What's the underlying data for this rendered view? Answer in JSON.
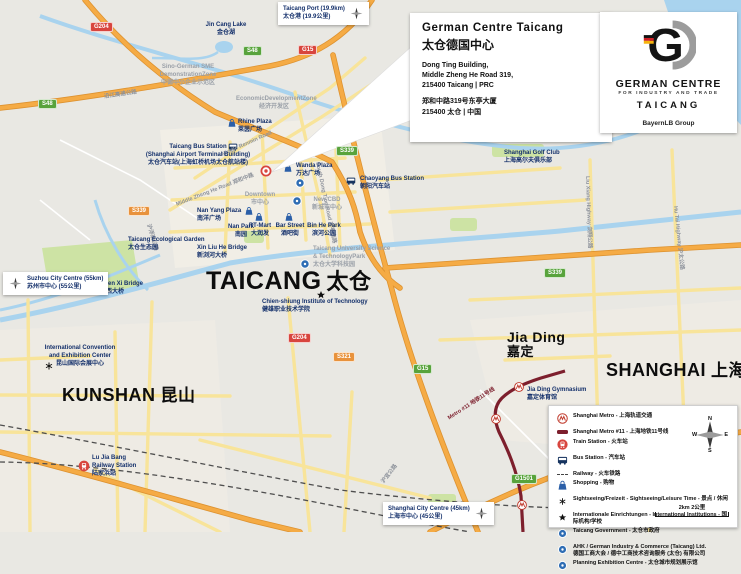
{
  "callout": {
    "title_en": "German Centre Taicang",
    "title_zh": "太仓德国中心",
    "address_lines": [
      "Dong Ting Building,",
      "Middle Zheng He Road 319,",
      "215400 Taicang | PRC"
    ],
    "address_zh_lines": [
      "郑和中路319号东亭大厦",
      "215400 太仓 | 中国"
    ]
  },
  "logo_card": {
    "logo_letter": "G",
    "brand_line1": "GERMAN CENTRE",
    "brand_line2": "FOR INDUSTRY AND TRADE",
    "brand_city": "TAICANG",
    "brand_group": "BayernLB Group"
  },
  "distance_boxes": [
    {
      "en": "Taicang Port (19.9km)",
      "zh": "太仓港 (19.9公里)"
    },
    {
      "en": "Suzhou City Centre (55km)",
      "zh": "苏州市中心 (55公里)"
    },
    {
      "en": "Shanghai City Centre (45km)",
      "zh": "上海市中心 (45公里)"
    }
  ],
  "cities": [
    {
      "en": "TAICANG",
      "zh": "太仓"
    },
    {
      "en": "KUNSHAN",
      "zh": "昆山"
    },
    {
      "en": "SHANGHAI",
      "zh": "上海"
    },
    {
      "en": "Jia Ding",
      "zh": "嘉定"
    }
  ],
  "pois": [
    {
      "lines": [
        "Taicang Bus Station",
        "(Shanghai Airport Terminal Building)",
        "太仓汽车站(上海虹桥机场太仓航站楼)"
      ]
    },
    {
      "lines": [
        "Wanda Plaza",
        "万达广场"
      ]
    },
    {
      "lines": [
        "Chaoyang Bus Station",
        "朝阳汽车站"
      ]
    },
    {
      "lines": [
        "New CBD",
        "新城市中心"
      ]
    },
    {
      "lines": [
        "Downtown",
        "市中心"
      ]
    },
    {
      "lines": [
        "Nan Yang Plaza",
        "南洋广场"
      ]
    },
    {
      "lines": [
        "Nan Park",
        "南园"
      ]
    },
    {
      "lines": [
        "RT-Mart",
        "大润发"
      ]
    },
    {
      "lines": [
        "Bar Street",
        "酒吧街"
      ]
    },
    {
      "lines": [
        "Bin He Park",
        "滨河公园"
      ]
    },
    {
      "lines": [
        "Taicang Ecological Garden",
        "太仓生态园"
      ]
    },
    {
      "lines": [
        "Xin Liu He Bridge",
        "新浏河大桥"
      ]
    },
    {
      "lines": [
        "Taicang University Science",
        "& TechnologyPark",
        "太仓大学科技园"
      ]
    },
    {
      "lines": [
        "Chien-shiung Institute of Technology",
        "健雄职业技术学院"
      ]
    },
    {
      "lines": [
        "Chen Xi Bridge",
        "陈西大桥"
      ]
    },
    {
      "lines": [
        "International Convention",
        "and Exhibition Center",
        "昆山国际会展中心"
      ]
    },
    {
      "lines": [
        "Lu Jia Bang",
        "Railway Station",
        "陆家浜站"
      ]
    },
    {
      "lines": [
        "Jia Ding Gymnasium",
        "嘉定体育馆"
      ]
    },
    {
      "lines": [
        "Shanghai Golf Club",
        "上海高尔夫俱乐部"
      ]
    },
    {
      "lines": [
        "Jin Cang Lake",
        "金仓湖"
      ]
    },
    {
      "lines": [
        "Sino-German SME",
        "DemonstrationZone",
        "中德中小企业示范区"
      ]
    },
    {
      "lines": [
        "EconomicDevelopmentZone",
        "经济开发区"
      ]
    },
    {
      "lines": [
        "Rhine Plaza",
        "莱茵广场"
      ]
    }
  ],
  "road_labels": [
    {
      "text": "Middle Renmin Road"
    },
    {
      "text": "Middle Zheng He Road 郑和中路"
    },
    {
      "text": "South Dong Ting Road 东亭南路"
    },
    {
      "text": "沪浮璜公路"
    },
    {
      "text": "Liu Xiang Highway 浏翔公路"
    },
    {
      "text": "Hu Tai Highway 沪太公路"
    },
    {
      "text": "沿江高速公路"
    },
    {
      "text": "沪宜公路"
    }
  ],
  "metro_label": {
    "text": "Metro #11 地铁11号线"
  },
  "water_label": {
    "text": "Yangtze River 长江"
  },
  "road_badges": [
    {
      "text": "G204"
    },
    {
      "text": "S48"
    },
    {
      "text": "S48"
    },
    {
      "text": "G15"
    },
    {
      "text": "S339"
    },
    {
      "text": "S339"
    },
    {
      "text": "S339"
    },
    {
      "text": "G204"
    },
    {
      "text": "S321"
    },
    {
      "text": "G15"
    },
    {
      "text": "G1501"
    }
  ],
  "legend": {
    "items": [
      {
        "icon": "metro-logo-icon",
        "text": "Shanghai Metro - 上海轨道交通"
      },
      {
        "icon": "metro-line-icon",
        "text": "Shanghai Metro #11 - 上海地铁11号线"
      },
      {
        "icon": "train-station-icon",
        "text": "Train Station - 火车站"
      },
      {
        "icon": "bus-station-icon",
        "text": "Bus Station - 汽车站"
      },
      {
        "icon": "railway-icon",
        "text": "Railway - 火车铁路"
      },
      {
        "icon": "shopping-bag-icon",
        "text": "Shopping - 购物"
      },
      {
        "icon": "sightseeing-icon",
        "text": "Sightseeing/Freizeit - Sightseeing/Leisure Time - 景点 / 休闲"
      },
      {
        "icon": "international-icon",
        "text": "Internationale Einrichtungen - International Institutions - 国际机构/学校"
      },
      {
        "icon": "blue-marker-icon",
        "text": "Taicang Government - 太仓市政府"
      },
      {
        "icon": "blue-marker-icon",
        "text": "AHK / German Industry & Commerce (Taicang) Ltd.",
        "text2": "德国工商大会 / 德中工商技术咨询服务 (太仓) 有限公司"
      },
      {
        "icon": "blue-marker-icon",
        "text": "Planning Exhibition Centre - 太仓城市规划展示馆"
      }
    ],
    "scale_label": "2km 2公里",
    "compass": {
      "n": "N",
      "e": "E",
      "s": "S",
      "w": "W"
    }
  },
  "icons": {
    "marker": "german-centre-marker-icon",
    "bus": "bus-station-icon",
    "train": "train-station-icon",
    "metro": "metro-logo-icon",
    "shopping": "shopping-bag-icon",
    "sightseeing": "sightseeing-asterisk-icon",
    "international": "international-star-icon",
    "poi": "blue-marker-icon",
    "compass": "compass-rose-icon"
  },
  "colors": {
    "national_road_badge": "#d8453e",
    "provincial_road_badge": "#58a33c",
    "expressway_badge": "#e8923c",
    "metro_line": "#7d1f2d",
    "water": "#a9d3ee",
    "highway_orange": "#f5ab45",
    "secondary_yellow": "#f8e49a",
    "park_green": "#cde3a4",
    "poi_blue": "#2e6db4",
    "label_navy": "#14306b"
  }
}
